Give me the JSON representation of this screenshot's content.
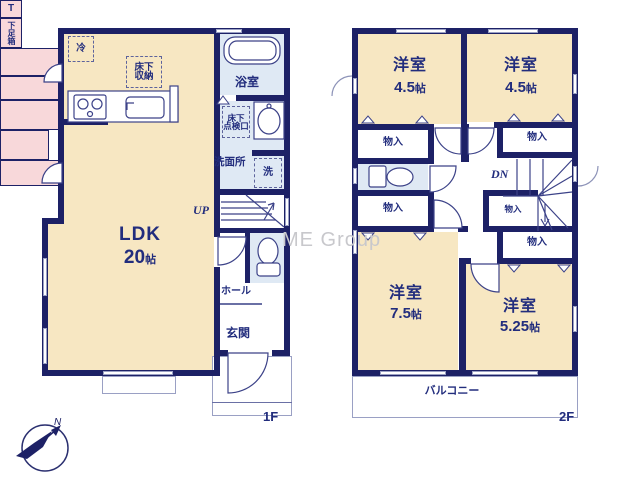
{
  "watermark": "ME Group",
  "compass": {
    "north": "N"
  },
  "colors": {
    "wall": "#1d2166",
    "room_cream": "#f7e7c2",
    "closet_pink": "#f8d8da",
    "wet_blue": "#dfe9f4",
    "label_navy": "#222d7d"
  },
  "floor1": {
    "label": "1F",
    "ldk": {
      "name": "LDK",
      "size": "20",
      "unit": "帖"
    },
    "bathroom": "浴室",
    "washroom": "洗面所",
    "underfloor_hatch": {
      "line1": "床下",
      "line2": "点検口"
    },
    "underfloor_storage": {
      "line1": "床下",
      "line2": "収納"
    },
    "fridge": "冷",
    "washer": "洗",
    "stairs_up": "UP",
    "hall": "ホール",
    "shoe_cabinet_t": "T",
    "shoe_cabinet": "下足箱",
    "entrance": "玄関"
  },
  "floor2": {
    "label": "2F",
    "stairs_down": "DN",
    "balcony": "バルコニー",
    "closets": [
      "物入",
      "物入",
      "物入",
      "物入",
      "物入"
    ],
    "rooms": {
      "nw": {
        "name": "洋室",
        "size": "4.5",
        "unit": "帖"
      },
      "ne": {
        "name": "洋室",
        "size": "4.5",
        "unit": "帖"
      },
      "sw": {
        "name": "洋室",
        "size": "7.5",
        "unit": "帖"
      },
      "se": {
        "name": "洋室",
        "size": "5.25",
        "unit": "帖"
      }
    }
  }
}
